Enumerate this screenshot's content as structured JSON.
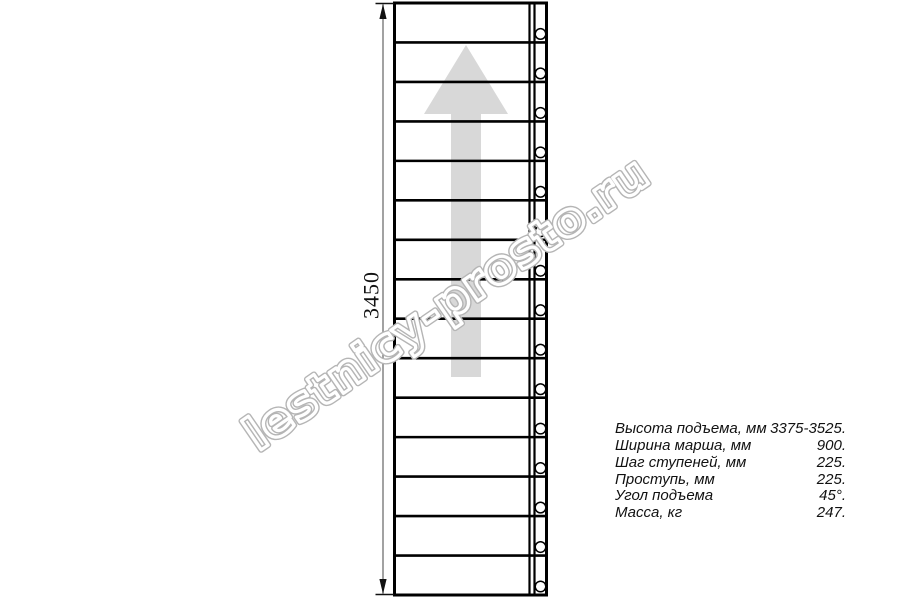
{
  "drawing": {
    "type": "staircase-plan-view",
    "tread_count": 15,
    "dimension_label": "3450",
    "direction_arrow": "up",
    "colors": {
      "line": "#000000",
      "arrow_fill": "#d8d8d8",
      "dimension_line": "#7a7a7a",
      "dimension_marks": "#111111",
      "watermark_outline": "#b5b5b5",
      "watermark_inner": "#ffffff",
      "circle_fill": "#ffffff"
    }
  },
  "watermark": {
    "text": "lestnicy-prosto.ru"
  },
  "specs": {
    "rows": [
      {
        "label": "Высота подъема, мм",
        "value": "3375-3525."
      },
      {
        "label": "Ширина марша, мм",
        "value": "900."
      },
      {
        "label": "Шаг ступеней, мм",
        "value": "225."
      },
      {
        "label": "Проступь, мм",
        "value": "225."
      },
      {
        "label": "Угол подъема",
        "value": "45°."
      },
      {
        "label": "Масса, кг",
        "value": "247."
      }
    ]
  }
}
